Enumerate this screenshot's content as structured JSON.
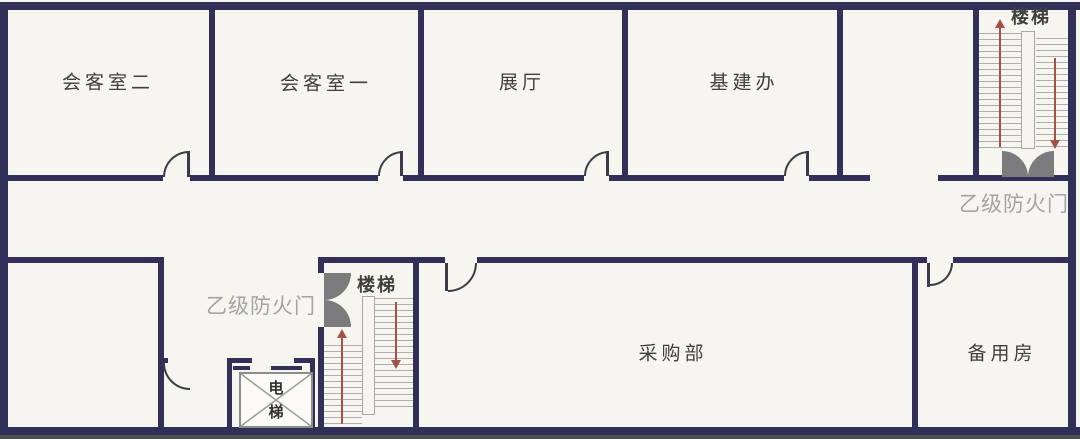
{
  "rooms": {
    "reception2": {
      "label": "会客室二"
    },
    "reception1": {
      "label": "会客室一"
    },
    "exhibition": {
      "label": "展厅"
    },
    "infrastructure": {
      "label": "基建办"
    },
    "procurement": {
      "label": "采购部"
    },
    "spare_room": {
      "label": "备用房"
    }
  },
  "stairwells": {
    "top": {
      "label": "楼梯",
      "arrows": [
        "up",
        "down"
      ]
    },
    "bottom": {
      "label": "楼梯",
      "arrows": [
        "up",
        "down"
      ]
    }
  },
  "fire_doors": {
    "top_right": {
      "label": "乙级防火门"
    },
    "lobby": {
      "label": "乙级防火门"
    }
  },
  "elevator": {
    "label": "电梯",
    "char_top": "电",
    "char_bottom": "梯"
  },
  "colors": {
    "wall": "#322f58",
    "background": "#f7f5f0",
    "fire_door_leaf": "#7b7b7d",
    "gray_label": "#a4a4a6",
    "stair_tread": "#aeadab",
    "arrow_red": "#a3524a",
    "room_text": "#404040",
    "bottom_edge_strip": "#4f4f4f"
  }
}
